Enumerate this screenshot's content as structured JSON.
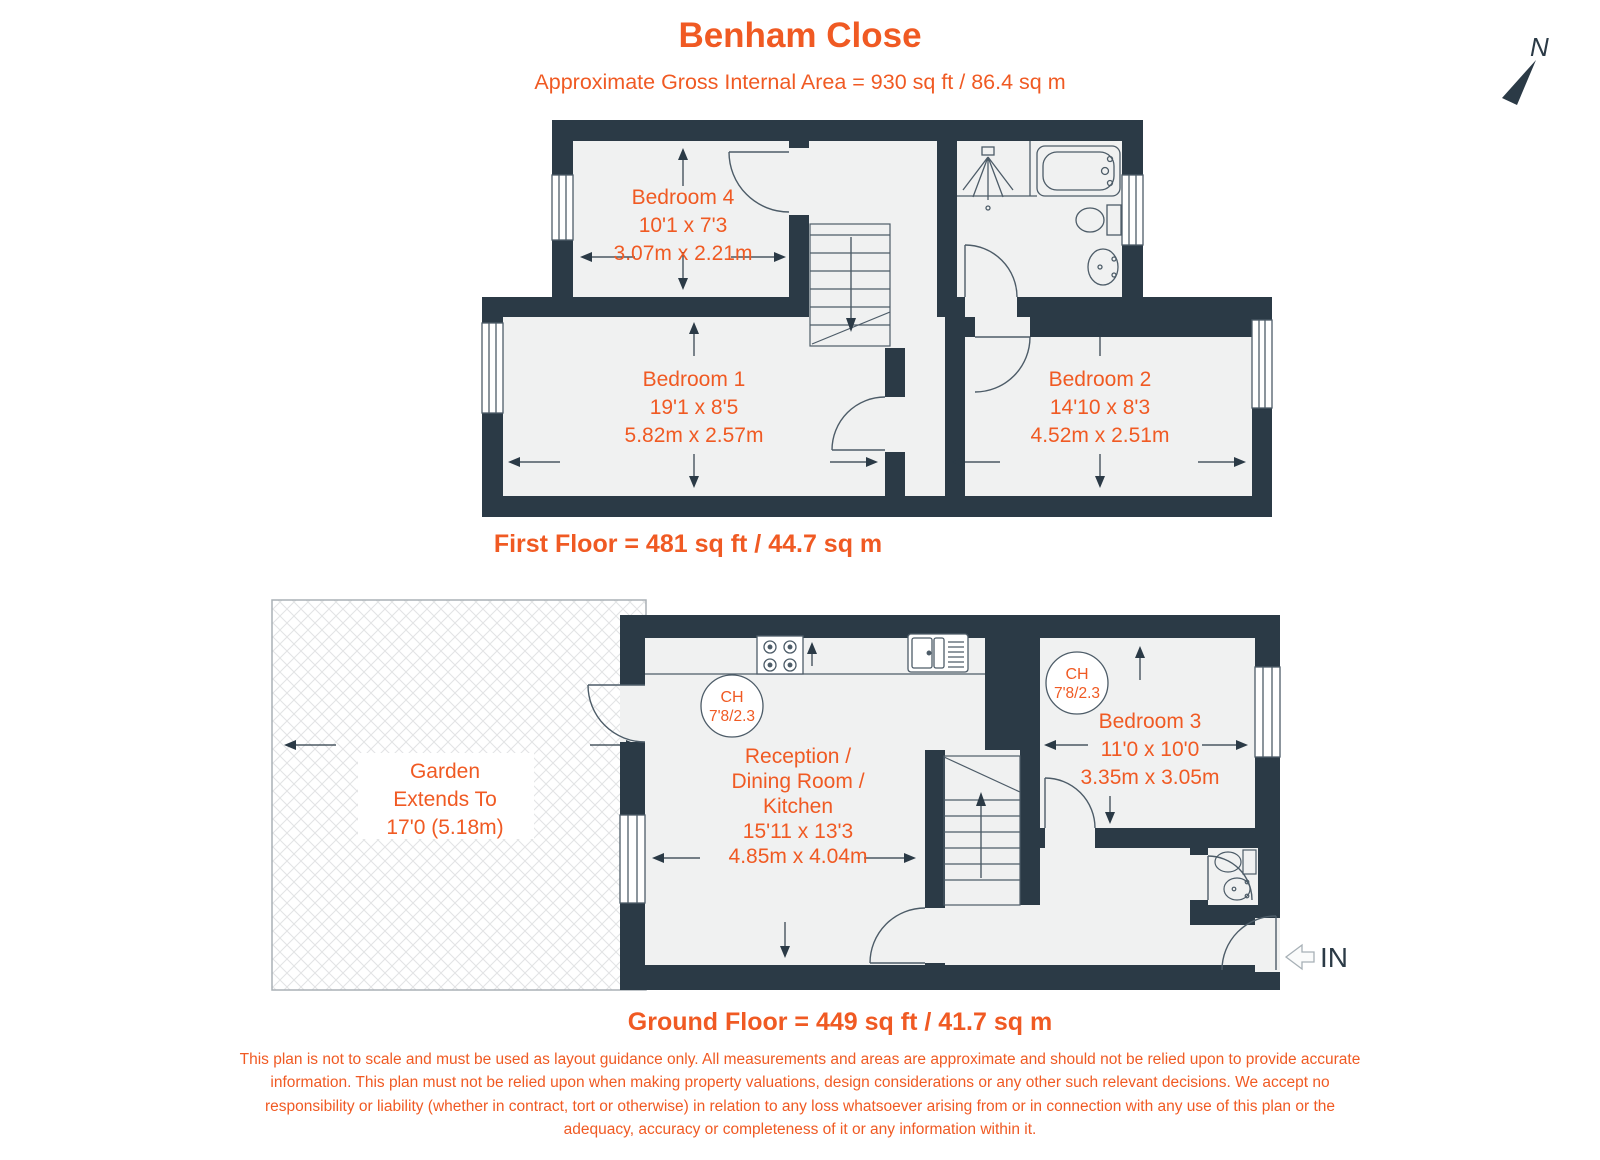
{
  "header": {
    "title": "Benham Close",
    "subtitle": "Approximate Gross Internal Area = 930 sq ft / 86.4 sq m",
    "north_label": "N"
  },
  "palette": {
    "accent_orange": "#f05a23",
    "wall_dark": "#2b3a46",
    "floor_light": "#f0f1f1",
    "detail_line": "#4d5c68"
  },
  "first_floor": {
    "caption": "First Floor = 481 sq ft / 44.7 sq m",
    "rooms": [
      {
        "name": "Bedroom 4",
        "size_imperial": "10'1 x 7'3",
        "size_metric": "3.07m x 2.21m"
      },
      {
        "name": "Bedroom 1",
        "size_imperial": "19'1 x 8'5",
        "size_metric": "5.82m x 2.57m"
      },
      {
        "name": "Bedroom 2",
        "size_imperial": "14'10 x 8'3",
        "size_metric": "4.52m x 2.51m"
      }
    ]
  },
  "ground_floor": {
    "caption": "Ground Floor = 449 sq ft / 41.7 sq m",
    "garden": {
      "line1": "Garden",
      "line2": "Extends To",
      "line3": "17'0 (5.18m)"
    },
    "reception": {
      "line1": "Reception /",
      "line2": "Dining Room /",
      "line3": "Kitchen",
      "size_imperial": "15'11 x 13'3",
      "size_metric": "4.85m x 4.04m"
    },
    "bedroom3": {
      "name": "Bedroom 3",
      "size_imperial": "11'0 x 10'0",
      "size_metric": "3.35m x 3.05m"
    },
    "ceiling_height_badge": {
      "line1": "CH",
      "line2": "7'8/2.3"
    },
    "entrance_label": "IN"
  },
  "disclaimer": "This plan is not to scale and must be used as layout guidance only. All measurements and areas are approximate and should not be relied upon to provide accurate information. This plan must not be relied upon when making property valuations, design considerations or any other such relevant decisions. We accept no responsibility or liability (whether in contract, tort or otherwise) in relation to any loss whatsoever arising from or in connection with any use of this plan or the adequacy, accuracy or completeness of it or any information within it."
}
